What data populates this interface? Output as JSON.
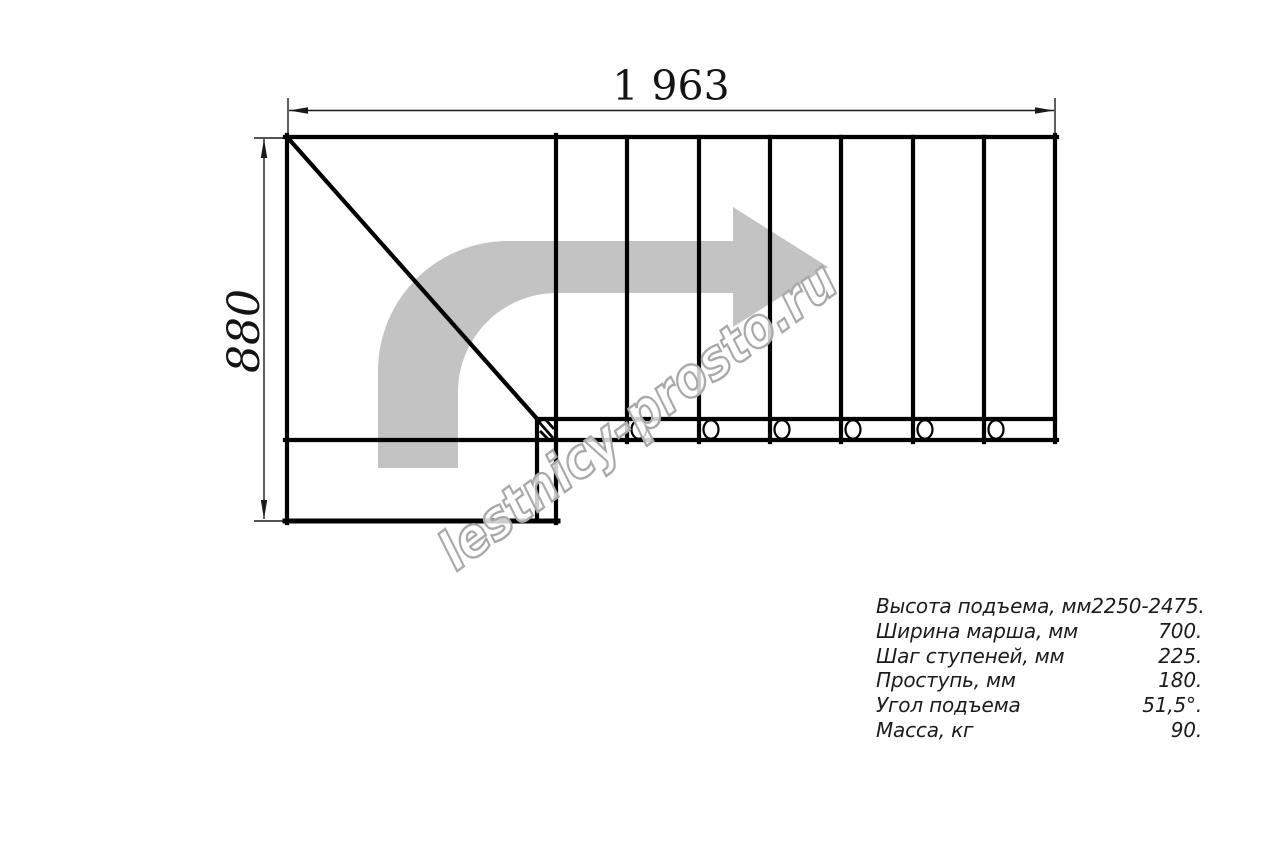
{
  "page": {
    "background": "#ffffff"
  },
  "drawing": {
    "top_dimension_label": "1 963",
    "side_dimension_label": "880",
    "line_color": "#000000",
    "dimension_color": "#1a1a1a",
    "arrow_color": "#c3c3c3"
  },
  "watermark": {
    "text": "lestnicy-prosto.ru",
    "stroke_color": "#a9a9a9"
  },
  "specs": {
    "rows": [
      {
        "label": "Высота подъема, мм",
        "value": "2250-2475."
      },
      {
        "label": "Ширина марша, мм",
        "value": "700."
      },
      {
        "label": "Шаг ступеней, мм",
        "value": "225."
      },
      {
        "label": "Проступь, мм",
        "value": "180."
      },
      {
        "label": "Угол подъема",
        "value": "51,5°."
      },
      {
        "label": "Масса, кг",
        "value": "90."
      }
    ]
  }
}
